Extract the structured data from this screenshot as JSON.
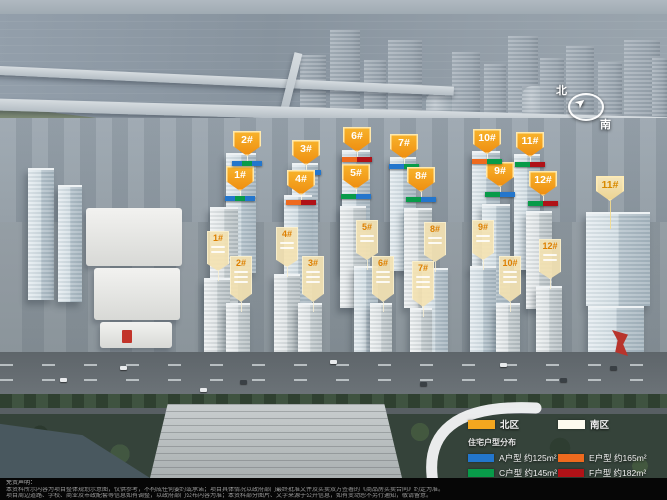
{
  "compass": {
    "north_label": "北",
    "south_label": "南"
  },
  "legend": {
    "zones": [
      {
        "label": "北区",
        "color": "#F3A71F"
      },
      {
        "label": "南区",
        "color": "#FDFBEF"
      }
    ],
    "units_title": "住宅户型分布",
    "units": [
      {
        "letter": "A",
        "label": "A户型 约125m²",
        "color": "#2376CC"
      },
      {
        "letter": "C",
        "label": "C户型 约145m²",
        "color": "#089B49"
      },
      {
        "letter": "E",
        "label": "E户型 约165m²",
        "color": "#EE6A1E"
      },
      {
        "letter": "F",
        "label": "F户型 约182m²",
        "color": "#B01217"
      }
    ]
  },
  "markers": {
    "north": [
      {
        "label": "1#",
        "x": 240,
        "y": 166,
        "bar": [
          "A",
          "C",
          "A"
        ]
      },
      {
        "label": "2#",
        "x": 247,
        "y": 131,
        "bar": [
          "A",
          "C",
          "A"
        ]
      },
      {
        "label": "3#",
        "x": 306,
        "y": 140,
        "bar": [
          "C",
          "A"
        ]
      },
      {
        "label": "4#",
        "x": 301,
        "y": 170,
        "bar": [
          "E",
          "F"
        ]
      },
      {
        "label": "5#",
        "x": 356,
        "y": 164,
        "bar": [
          "C",
          "A"
        ]
      },
      {
        "label": "6#",
        "x": 357,
        "y": 127,
        "bar": [
          "E",
          "F"
        ]
      },
      {
        "label": "7#",
        "x": 404,
        "y": 134,
        "bar": [
          "A",
          "C"
        ]
      },
      {
        "label": "8#",
        "x": 421,
        "y": 167,
        "bar": [
          "C",
          "A"
        ]
      },
      {
        "label": "9#",
        "x": 500,
        "y": 162,
        "bar": [
          "C",
          "A"
        ]
      },
      {
        "label": "10#",
        "x": 487,
        "y": 129,
        "bar": [
          "E",
          "C"
        ]
      },
      {
        "label": "11#",
        "x": 530,
        "y": 132,
        "bar": [
          "C",
          "F"
        ]
      },
      {
        "label": "12#",
        "x": 543,
        "y": 171,
        "bar": [
          "C",
          "F"
        ]
      }
    ],
    "south": [
      {
        "label": "1#",
        "x": 218,
        "y": 231,
        "sublines": 2
      },
      {
        "label": "2#",
        "x": 241,
        "y": 256,
        "sublines": 3
      },
      {
        "label": "3#",
        "x": 313,
        "y": 256,
        "sublines": 3
      },
      {
        "label": "4#",
        "x": 287,
        "y": 227,
        "sublines": 2
      },
      {
        "label": "5#",
        "x": 367,
        "y": 220,
        "sublines": 2
      },
      {
        "label": "6#",
        "x": 383,
        "y": 256,
        "sublines": 3
      },
      {
        "label": "7#",
        "x": 423,
        "y": 261,
        "sublines": 3
      },
      {
        "label": "8#",
        "x": 435,
        "y": 222,
        "sublines": 2
      },
      {
        "label": "9#",
        "x": 483,
        "y": 220,
        "sublines": 2
      },
      {
        "label": "10#",
        "x": 510,
        "y": 256,
        "sublines": 3
      },
      {
        "label": "11#",
        "x": 610,
        "y": 176,
        "sublines": 0
      },
      {
        "label": "12#",
        "x": 550,
        "y": 239,
        "sublines": 2
      }
    ]
  },
  "disclaimer": {
    "lead": "免责声明：",
    "line1": "本资料所示内容为项目整体规划示意图，仅供参考，不构成任何要约或承诺；项目具体情况以政府部门最终批准文件及买卖双方签署的《商品房买卖合同》约定为准。",
    "line2": "项目周边道路、学校、商业及市政配套等信息如有调整，以政府部门公布内容为准；本资料部分图片、文字来源于公开信息，如有变动恕不另行通知，敬请留意。"
  }
}
